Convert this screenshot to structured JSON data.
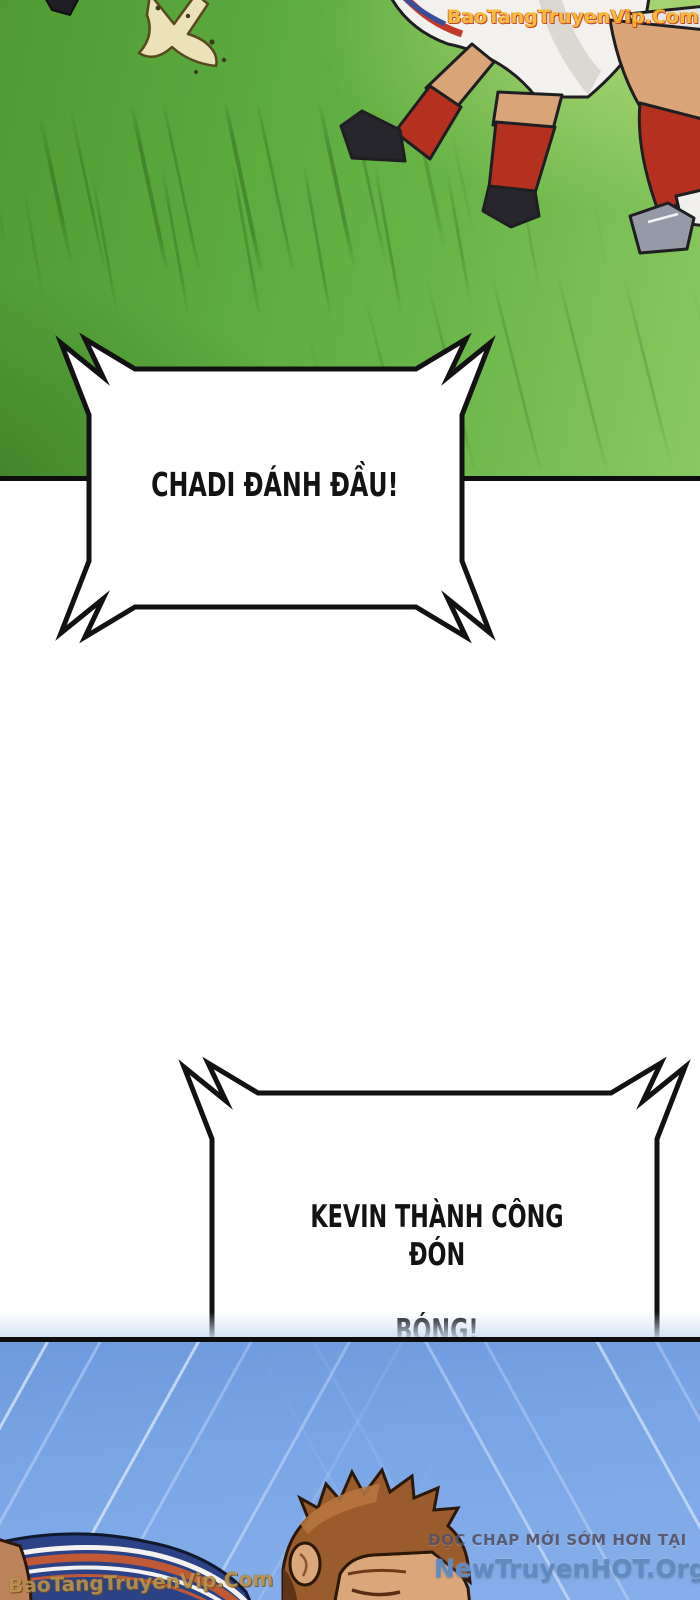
{
  "page": {
    "kind": "manhwa-comic-page",
    "width": 700,
    "height": 1600
  },
  "watermarks": {
    "top_right": "BaoTangTruyenVip.Com",
    "bottom_left": "BaoTangTruyenVip.Com"
  },
  "promo": {
    "line1": "ĐỌC CHAP MỚI SỚM HƠN TẠI",
    "line2": "NewTruyenHOT.Org"
  },
  "speech_bubbles": [
    {
      "id": 1,
      "text": "CHADI ĐÁNH ĐẦU!"
    },
    {
      "id": 2,
      "line1": "KEVIN THÀNH CÔNG ĐÓN",
      "line2": "BÓNG!"
    }
  ],
  "scene": {
    "panel1": "soccer pitch seen from low angle; running players' legs with red socks, white shorts, dark and grey cleats; turf kick-up splash at top left",
    "panel2": "blue speed-line background; player lying on the ground with auburn spiky hair, navy jacket with white and red trim stripes"
  },
  "colors": {
    "grass_green": "#5cab3e",
    "grass_light": "#8ac862",
    "panel_blue": "#7ba6e6",
    "sock_red": "#b6301f",
    "skin": "#d9a478",
    "jacket_navy": "#2c4286",
    "hair_auburn": "#9a5b2d",
    "watermark_gold": "#f6b830",
    "watermark_gold_dim": "#b8914d",
    "promo_grey": "#555062",
    "promo_blue": "#5f8ac2",
    "ink": "#0e0e0e"
  }
}
